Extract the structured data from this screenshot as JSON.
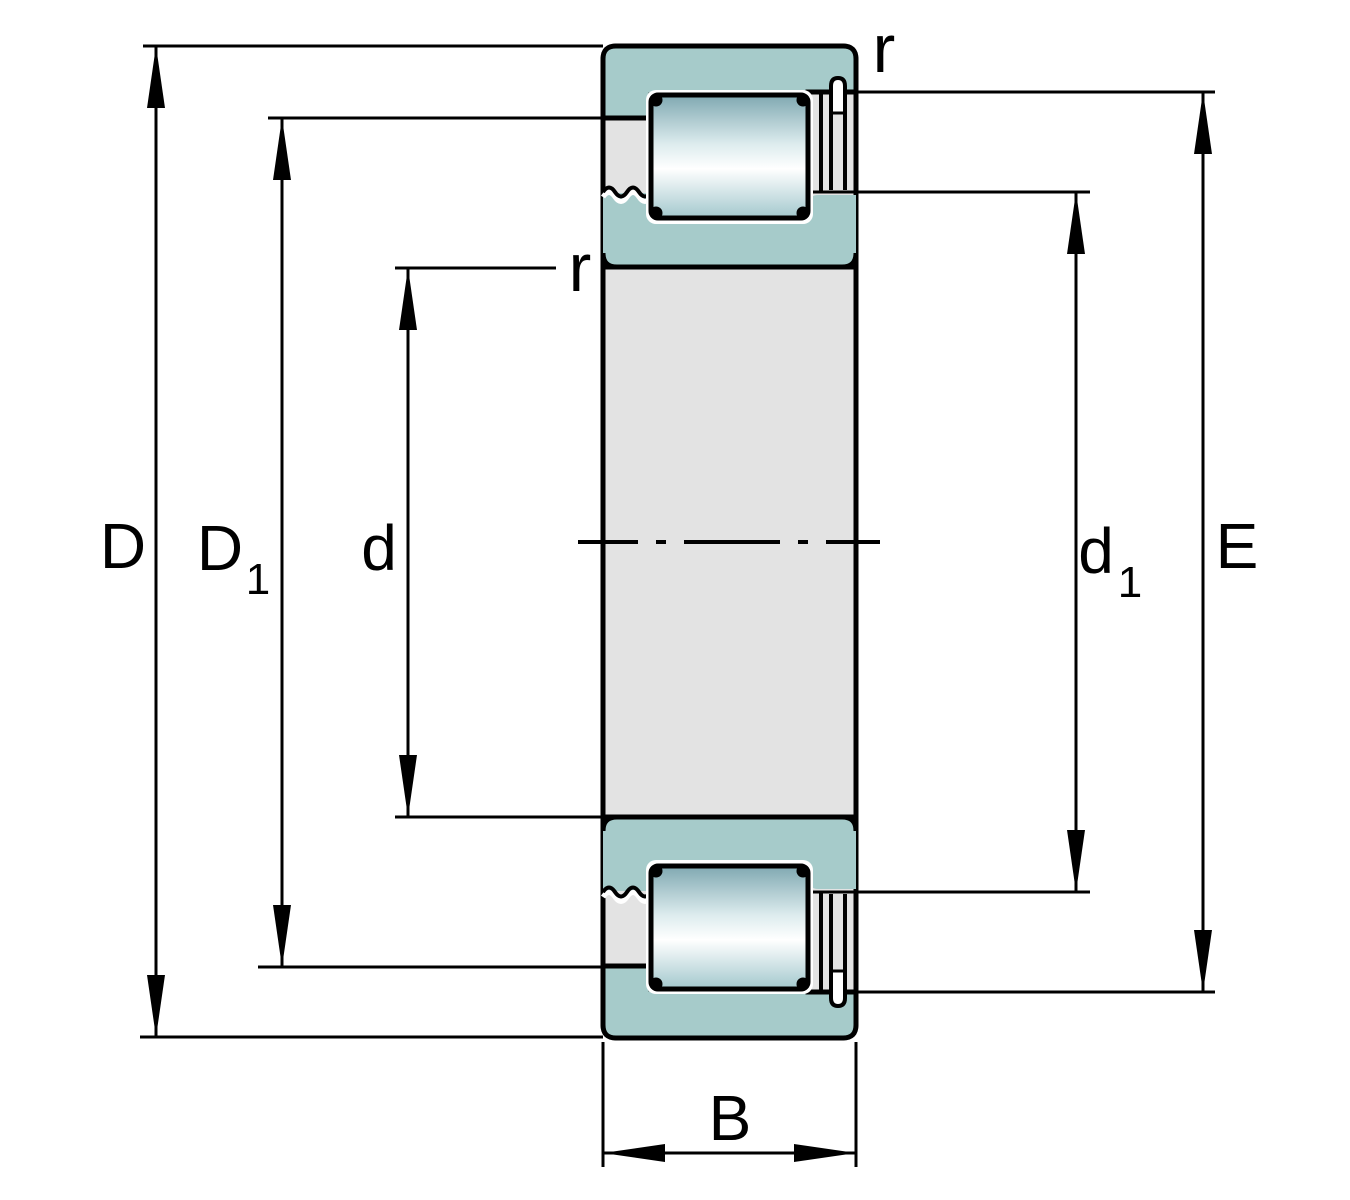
{
  "diagram": {
    "description": "Cylindrical roller bearing cross-section dimension drawing",
    "labels": {
      "D": {
        "symbol": "D"
      },
      "D1": {
        "symbol": "D",
        "subscript": "1"
      },
      "d": {
        "symbol": "d"
      },
      "d1": {
        "symbol": "d",
        "subscript": "1"
      },
      "E": {
        "symbol": "E"
      },
      "B": {
        "symbol": "B"
      },
      "r_outer": {
        "symbol": "r"
      },
      "r_inner": {
        "symbol": "r"
      }
    },
    "colors": {
      "ring_teal": "#a6cbca",
      "section_gray": "#e3e3e3",
      "roller_dark": "#7fa8b1",
      "roller_light": "#ffffff",
      "roller_base": "#a3c8cd",
      "outline": "#000000",
      "background": "#ffffff"
    }
  }
}
